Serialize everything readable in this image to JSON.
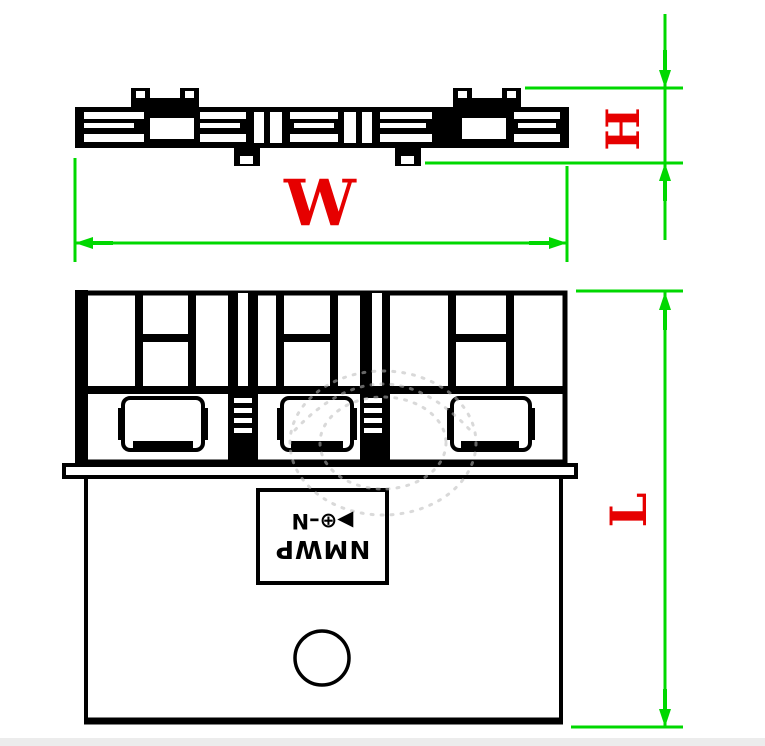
{
  "dimensions": {
    "width_label": "W",
    "height_label": "H",
    "length_label": "L"
  },
  "label_plate": {
    "brand": "NMWP",
    "logo": "▶⊕–N",
    "orientation": "rotated-180"
  },
  "colors": {
    "dimension_line_green": "#00D800",
    "dimension_text_red": "#E60000",
    "drawing_line_black": "#000000",
    "watermark_gray": "#BBBBBB",
    "background": "#FFFFFF"
  }
}
